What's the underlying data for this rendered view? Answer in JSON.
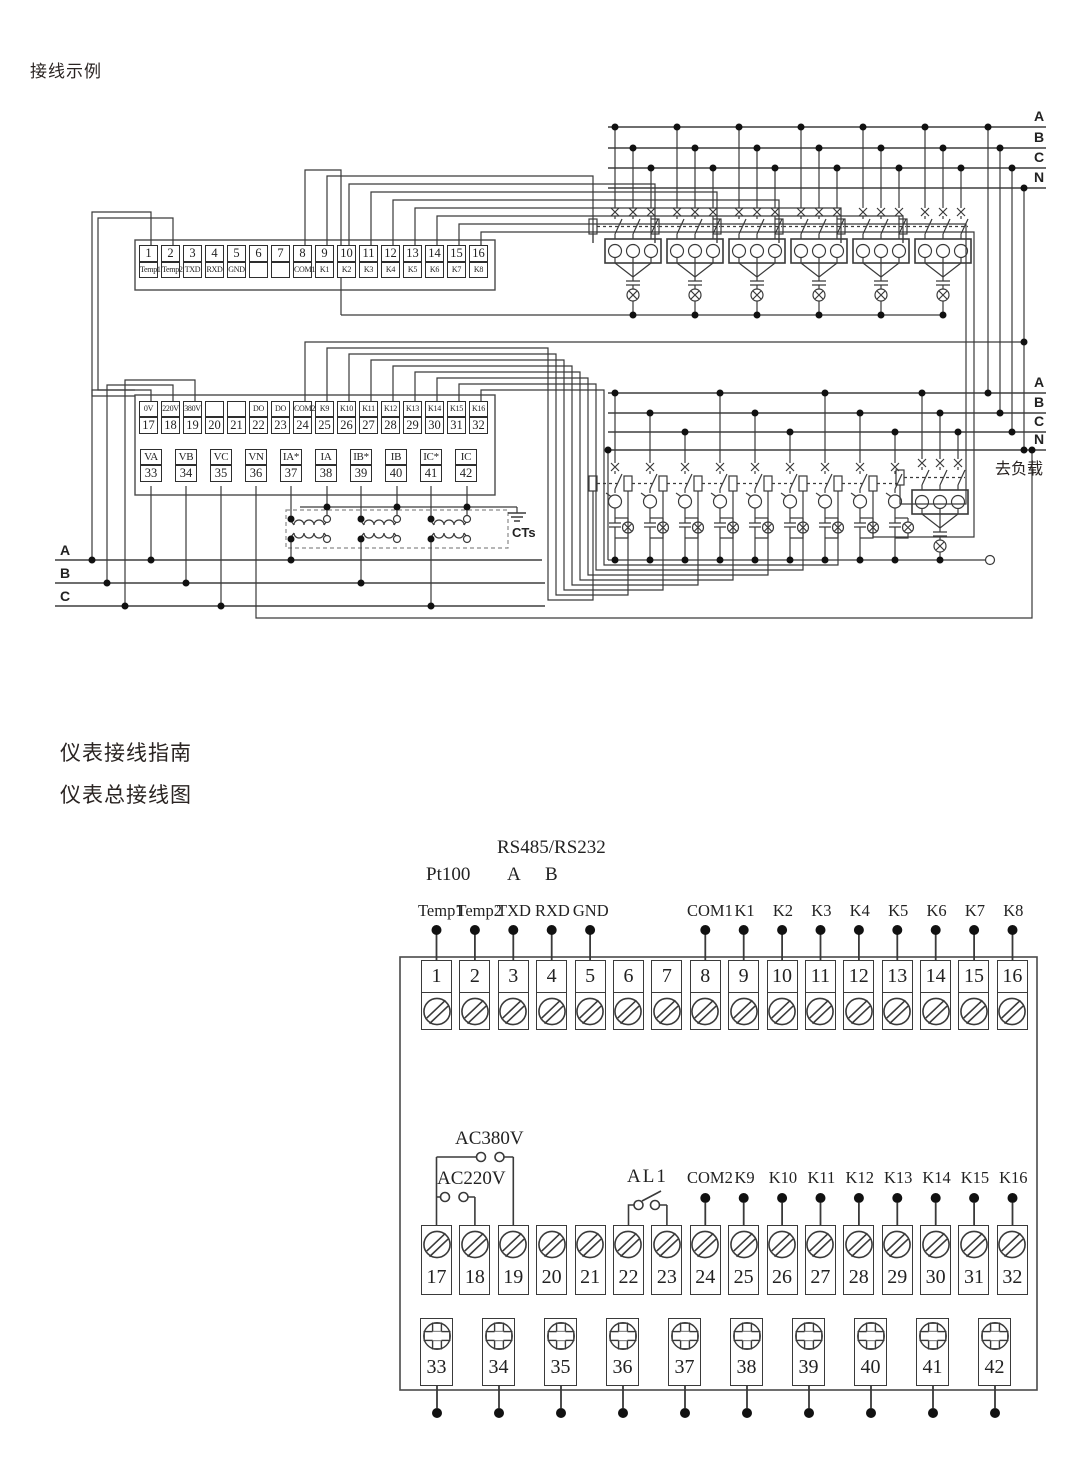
{
  "page": {
    "title": "接线示例",
    "guide_title": "仪表接线指南",
    "diagram_title": "仪表总接线图"
  },
  "top_diagram": {
    "row1": [
      {
        "n": "1",
        "t": "Temp1"
      },
      {
        "n": "2",
        "t": "Temp2"
      },
      {
        "n": "3",
        "t": "TXD"
      },
      {
        "n": "4",
        "t": "RXD"
      },
      {
        "n": "5",
        "t": "GND"
      },
      {
        "n": "6",
        "t": ""
      },
      {
        "n": "7",
        "t": ""
      },
      {
        "n": "8",
        "t": "COM1"
      },
      {
        "n": "9",
        "t": "K1"
      },
      {
        "n": "10",
        "t": "K2"
      },
      {
        "n": "11",
        "t": "K3"
      },
      {
        "n": "12",
        "t": "K4"
      },
      {
        "n": "13",
        "t": "K5"
      },
      {
        "n": "14",
        "t": "K6"
      },
      {
        "n": "15",
        "t": "K7"
      },
      {
        "n": "16",
        "t": "K8"
      }
    ],
    "row2": [
      {
        "t": "0V",
        "n": "17"
      },
      {
        "t": "220V",
        "n": "18"
      },
      {
        "t": "380V",
        "n": "19"
      },
      {
        "t": "",
        "n": "20"
      },
      {
        "t": "",
        "n": "21"
      },
      {
        "t": "DO",
        "n": "22"
      },
      {
        "t": "DO",
        "n": "23"
      },
      {
        "t": "COM2",
        "n": "24"
      },
      {
        "t": "K9",
        "n": "25"
      },
      {
        "t": "K10",
        "n": "26"
      },
      {
        "t": "K11",
        "n": "27"
      },
      {
        "t": "K12",
        "n": "28"
      },
      {
        "t": "K13",
        "n": "29"
      },
      {
        "t": "K14",
        "n": "30"
      },
      {
        "t": "K15",
        "n": "31"
      },
      {
        "t": "K16",
        "n": "32"
      }
    ],
    "row3": [
      {
        "t": "VA",
        "n": "33"
      },
      {
        "t": "VB",
        "n": "34"
      },
      {
        "t": "VC",
        "n": "35"
      },
      {
        "t": "VN",
        "n": "36"
      },
      {
        "t": "IA*",
        "n": "37"
      },
      {
        "t": "IA",
        "n": "38"
      },
      {
        "t": "IB*",
        "n": "39"
      },
      {
        "t": "IB",
        "n": "40"
      },
      {
        "t": "IC*",
        "n": "41"
      },
      {
        "t": "IC",
        "n": "42"
      }
    ],
    "bus_top": [
      "A",
      "B",
      "C",
      "N"
    ],
    "bus_mid": [
      "A",
      "B",
      "C",
      "N"
    ],
    "phases_left": [
      "A",
      "B",
      "C"
    ],
    "to_load": "去负载",
    "cts": "CTs"
  },
  "bottom_diagram": {
    "rs_title": "RS485/RS232",
    "pt100": "Pt100",
    "rs_a": "A",
    "rs_b": "B",
    "top_pins": [
      "Temp1",
      "Temp2",
      "TXD",
      "RXD",
      "GND"
    ],
    "relay_pins_top": [
      "COM1",
      "K1",
      "K2",
      "K3",
      "K4",
      "K5",
      "K6",
      "K7",
      "K8"
    ],
    "ac380": "AC380V",
    "ac220": "AC220V",
    "al1": "AL1",
    "relay_pins_bottom": [
      "COM2",
      "K9",
      "K10",
      "K11",
      "K12",
      "K13",
      "K14",
      "K15",
      "K16"
    ],
    "row1_numbers": [
      "1",
      "2",
      "3",
      "4",
      "5",
      "6",
      "7",
      "8",
      "9",
      "10",
      "11",
      "12",
      "13",
      "14",
      "15",
      "16"
    ],
    "row2_numbers": [
      "17",
      "18",
      "19",
      "20",
      "21",
      "22",
      "23",
      "24",
      "25",
      "26",
      "27",
      "28",
      "29",
      "30",
      "31",
      "32"
    ],
    "row3_numbers": [
      "33",
      "34",
      "35",
      "36",
      "37",
      "38",
      "39",
      "40",
      "41",
      "42"
    ]
  }
}
